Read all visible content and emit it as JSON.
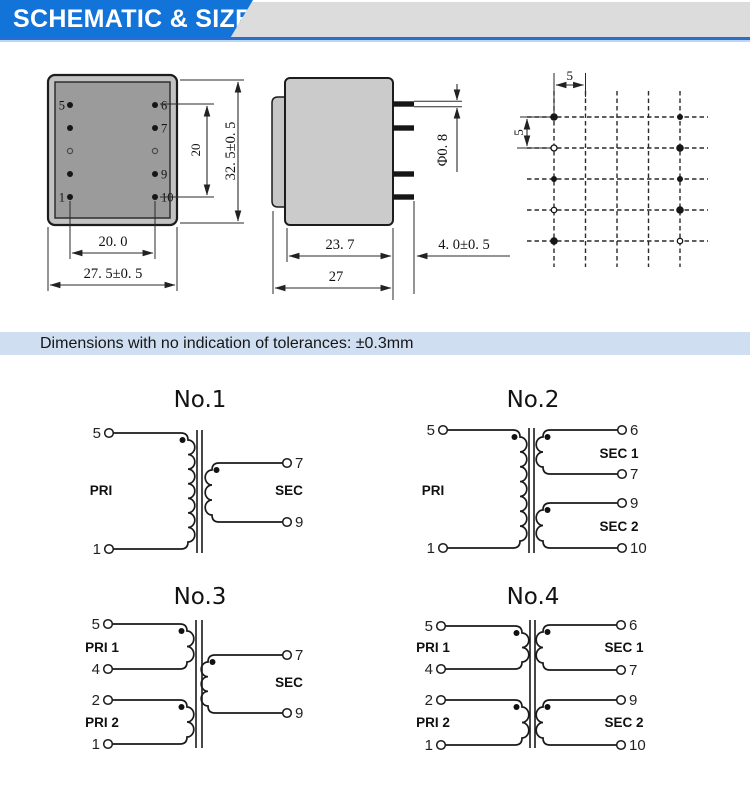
{
  "header": {
    "title": "SCHEMATIC & SIZE"
  },
  "tolerance_note": "Dimensions with no indication of tolerances: ±0.3mm",
  "colors": {
    "header-blue": "#1273d9",
    "header-bar-gray": "#dcdcdc",
    "header-line-blue": "#2f6cc9",
    "header-line-light": "#b5d8f9",
    "note-bg": "#cfdff1",
    "body-fill": "#c2c2c2",
    "body-inner-fill": "#9b9b9b",
    "side-body-fill": "#cbcbcb",
    "side-flange-fill": "#c6c6c6"
  },
  "mech": {
    "top_view": {
      "pins": {
        "p5": "5",
        "p6": "6",
        "p7": "7",
        "p9": "9",
        "p10": "10",
        "p1": "1"
      },
      "dim_inner_height": "20",
      "dim_height": "32. 5±0. 5",
      "dim_pin_span": "20. 0",
      "dim_width": "27. 5±0. 5"
    },
    "side_view": {
      "dim_pin_dia": "Φ0. 8",
      "dim_body_width": "23. 7",
      "dim_total_width": "27",
      "dim_pin_len": "4. 0±0. 5"
    },
    "grid_view": {
      "dim_pitch_h": "5",
      "dim_pitch_v": "5"
    }
  },
  "schematics": [
    {
      "title": "No.1",
      "left": [
        {
          "label": "PRI",
          "top": "5",
          "bottom": "1"
        }
      ],
      "right": [
        {
          "label": "SEC",
          "top": "7",
          "bottom": "9"
        }
      ]
    },
    {
      "title": "No.2",
      "left": [
        {
          "label": "PRI",
          "top": "5",
          "bottom": "1"
        }
      ],
      "right": [
        {
          "label": "SEC 1",
          "top": "6",
          "bottom": "7"
        },
        {
          "label": "SEC 2",
          "top": "9",
          "bottom": "10"
        }
      ]
    },
    {
      "title": "No.3",
      "left": [
        {
          "label": "PRI 1",
          "top": "5",
          "bottom": "4"
        },
        {
          "label": "PRI 2",
          "top": "2",
          "bottom": "1"
        }
      ],
      "right": [
        {
          "label": "SEC",
          "top": "7",
          "bottom": "9"
        }
      ]
    },
    {
      "title": "No.4",
      "left": [
        {
          "label": "PRI 1",
          "top": "5",
          "bottom": "4"
        },
        {
          "label": "PRI 2",
          "top": "2",
          "bottom": "1"
        }
      ],
      "right": [
        {
          "label": "SEC 1",
          "top": "6",
          "bottom": "7"
        },
        {
          "label": "SEC 2",
          "top": "9",
          "bottom": "10"
        }
      ]
    }
  ]
}
